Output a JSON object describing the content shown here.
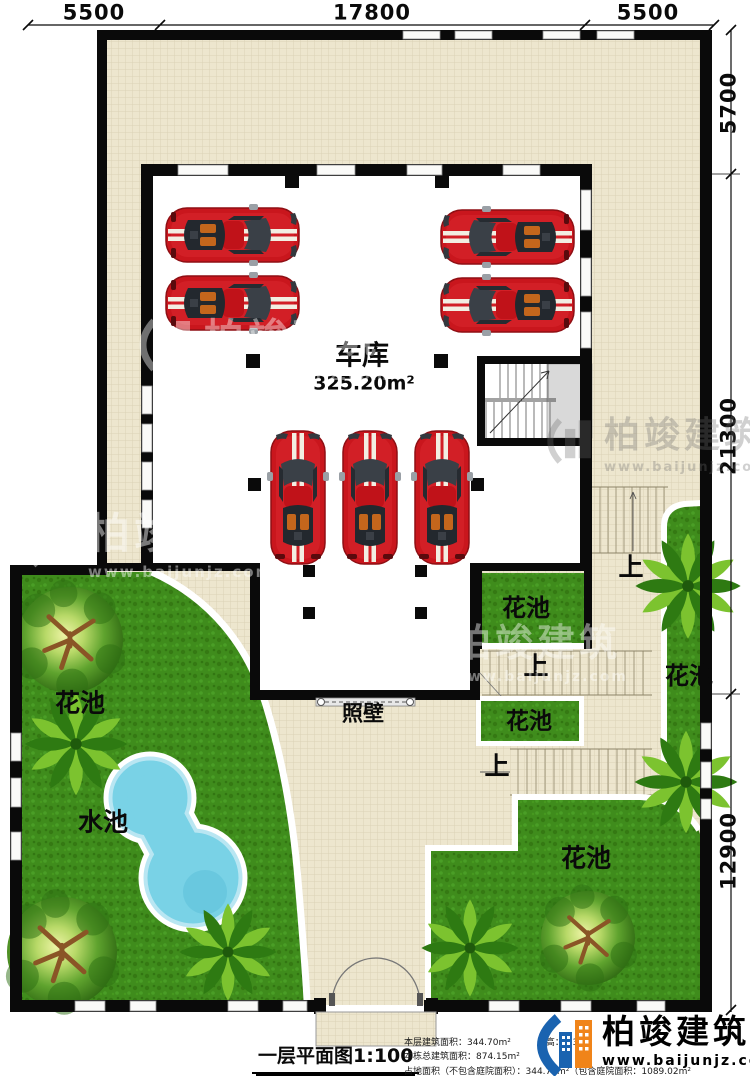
{
  "dims": {
    "top": [
      "5500",
      "17800",
      "5500"
    ],
    "right": [
      "5700",
      "21300",
      "12900"
    ]
  },
  "plan": {
    "garage_label": "车库",
    "garage_area": "325.20m²",
    "screen_wall": "照壁",
    "pool": "水池",
    "flower_bed": "花池",
    "up": "上"
  },
  "footer": {
    "title": "一层平面图1:100",
    "info1": "本层建筑面积：344.70m²",
    "floor_height": "层高：3.3m",
    "info2": "本栋总建筑面积：874.15m²",
    "info3": "占地面积（不包含庭院面积）：344.72m²（包含庭院面积：1089.02m²"
  },
  "brand": {
    "name": "柏竣建筑",
    "url": "www.baijunjz.com"
  },
  "watermark": {
    "name": "柏竣建筑",
    "url": "www.baijunjz.com"
  },
  "colors": {
    "wall": "#0a0a0a",
    "tile": "#EDE6CE",
    "grass": "#3F8C1C",
    "pool": "#79D2E6",
    "car": "#C9161D",
    "brand_blue": "#1A63B0",
    "brand_orange": "#F08419"
  }
}
